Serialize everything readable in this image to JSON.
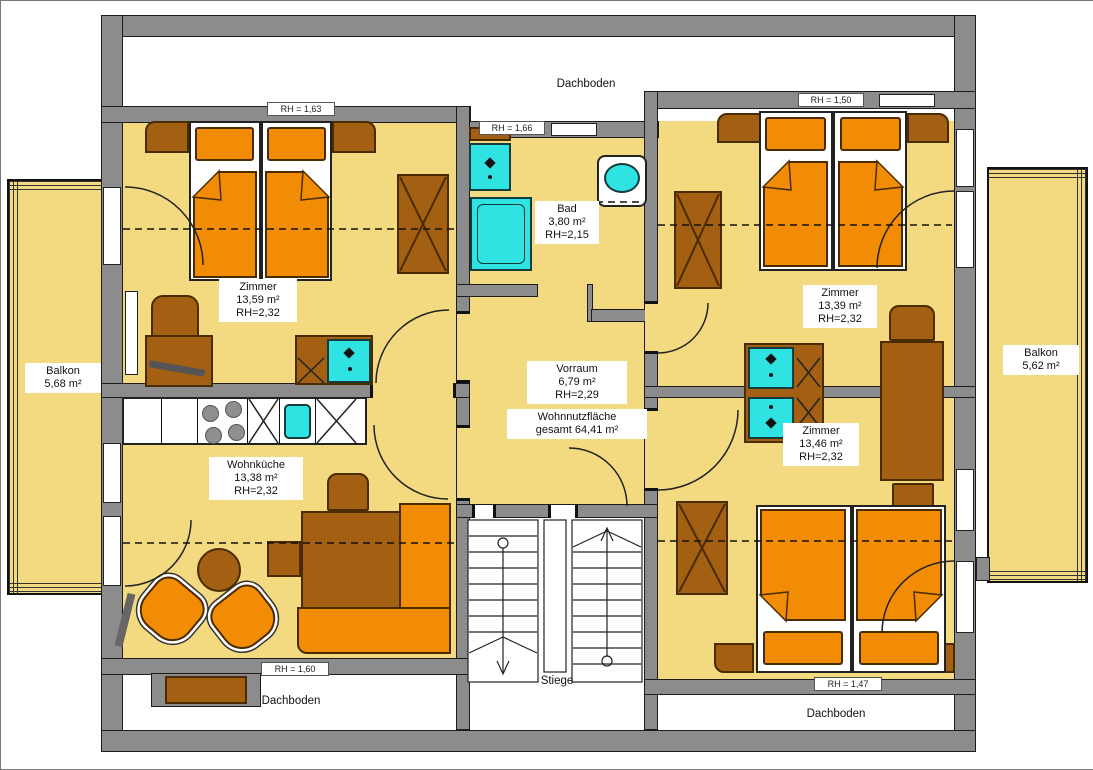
{
  "plan": {
    "attic": {
      "top": "Dachboden",
      "bottom_left": "Dachboden",
      "bottom_right": "Dachboden"
    },
    "stairs_label": "Stiege",
    "rooms": [
      {
        "name": "Zimmer",
        "area": "13,59 m²",
        "rh": "RH=2,32"
      },
      {
        "name": "Zimmer",
        "area": "13,39 m²",
        "rh": "RH=2,32"
      },
      {
        "name": "Zimmer",
        "area": "13,46 m²",
        "rh": "RH=2,32"
      },
      {
        "name": "Wohnküche",
        "area": "13,38 m²",
        "rh": "RH=2,32"
      },
      {
        "name": "Bad",
        "area": "3,80 m²",
        "rh": "RH=2,15"
      },
      {
        "name": "Vorraum",
        "area": "6,79 m²",
        "rh": "RH=2,29"
      },
      {
        "name": "Balkon",
        "area": "5,68 m²"
      },
      {
        "name": "Balkon",
        "area": "5,62 m²"
      }
    ],
    "total": {
      "line1": "Wohnnutzfläche",
      "line2": "gesamt 64,41 m²"
    },
    "markers": [
      {
        "text": "RH = 1,63"
      },
      {
        "text": "RH = 1,66"
      },
      {
        "text": "RH = 1,50"
      },
      {
        "text": "RH = 1,60"
      },
      {
        "text": "RH = 1,47"
      }
    ],
    "colors": {
      "wall": "#8c8c8c",
      "room": "#f3da81",
      "furniture_orange": "#f28c05",
      "furniture_brown": "#a35f12",
      "fixture_cyan": "#2fe3e3"
    }
  }
}
